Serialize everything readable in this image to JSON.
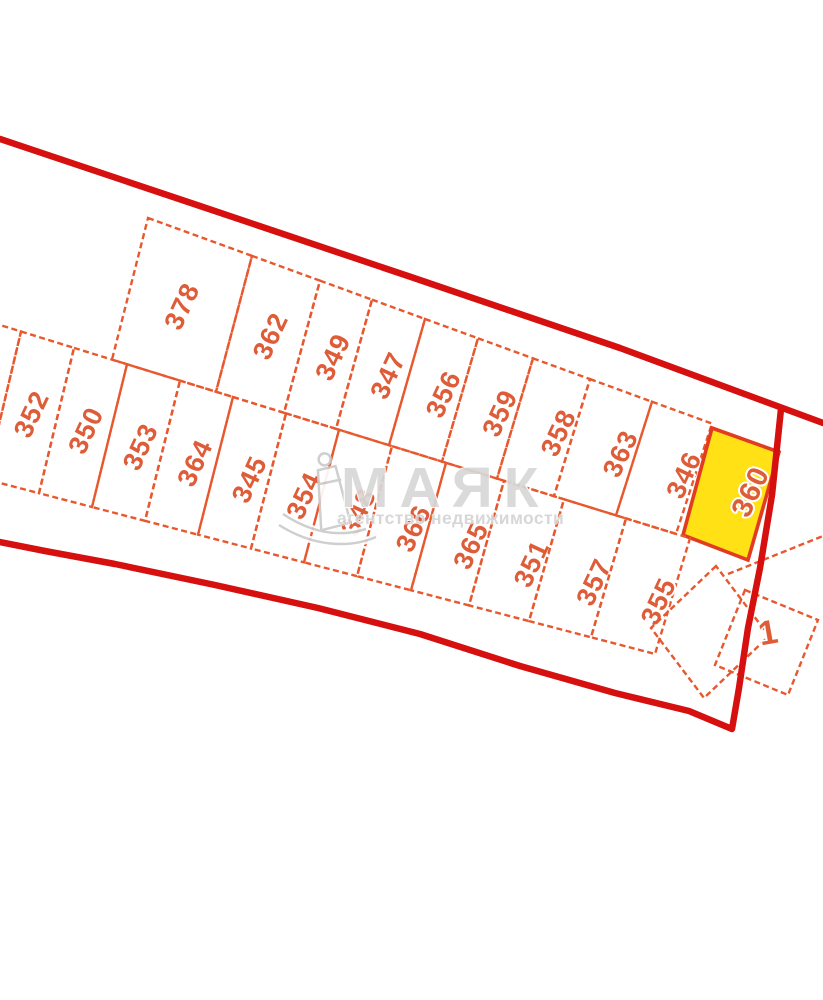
{
  "watermark": {
    "brand": "МАЯК",
    "tagline": "агентство недвижимости",
    "icon": "lighthouse-icon"
  },
  "map": {
    "boundary_color": "#d60f0f",
    "parcel_line_color": "#e8582e",
    "label_color": "#de5c38",
    "highlighted_parcel": {
      "label": "360",
      "fill": "#ffe115",
      "border": "#e33b20"
    },
    "rows": [
      {
        "name": "upper-row",
        "parcels": [
          {
            "label": "378"
          },
          {
            "label": "362"
          },
          {
            "label": "349"
          },
          {
            "label": "347"
          },
          {
            "label": "356"
          },
          {
            "label": "359"
          },
          {
            "label": "358"
          },
          {
            "label": "363"
          },
          {
            "label": "346"
          },
          {
            "label": "360",
            "highlighted": true
          }
        ]
      },
      {
        "name": "lower-row",
        "parcels": [
          {
            "label": ""
          },
          {
            "label": "352"
          },
          {
            "label": "350"
          },
          {
            "label": "353"
          },
          {
            "label": "364"
          },
          {
            "label": "345"
          },
          {
            "label": "354"
          },
          {
            "label": "348",
            "obscured": true
          },
          {
            "label": "366"
          },
          {
            "label": "365"
          },
          {
            "label": "351"
          },
          {
            "label": "357"
          },
          {
            "label": "355"
          }
        ]
      }
    ],
    "detached_parcels": [
      {
        "label": ""
      },
      {
        "label": "1"
      }
    ]
  }
}
